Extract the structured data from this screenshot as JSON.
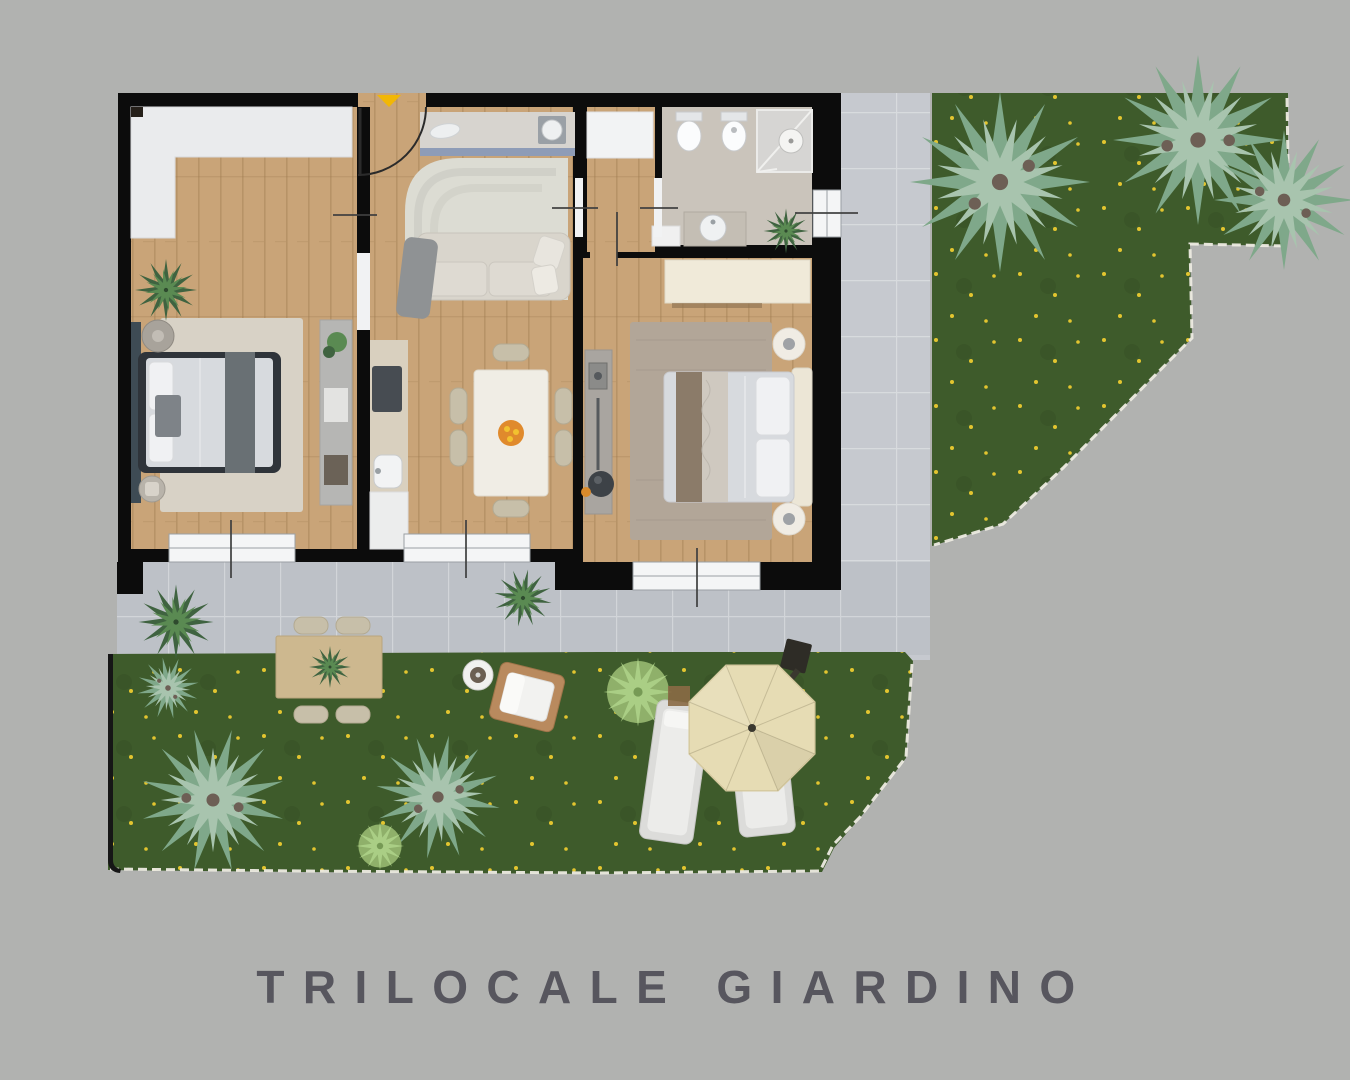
{
  "title": {
    "text": "TRILOCALE GIARDINO"
  },
  "colors": {
    "background": "#b1b2b0",
    "title_text": "#57565e",
    "wall": "#0c0c0c",
    "wood": "#c9a478",
    "wood_grain": "#9c7a4e",
    "bath_floor": "#cac4bb",
    "terrace": "#bdc1c7",
    "tile_grid": "#d2d5d9",
    "grass": "#3e5b2b",
    "grass_fringe": "#edebe2",
    "flower": "#e3c52f",
    "pine_dark": "#7fa88a",
    "pine_light": "#a8c4ae",
    "pine_core": "#6d5f55",
    "leaf_dark": "#3f6340",
    "leaf_light": "#5a8a52",
    "leaf_core": "#2e4a2e",
    "bush_base": "#8fb06a",
    "bush_star": "#aace85",
    "headboard_panel": "#3e4b54",
    "bed_frame": "#2f343a",
    "bedding": "#d7dade",
    "pillow": "#f0f1f3",
    "throw_blanket": "#697074",
    "rug_beige": "#d8d2c6",
    "rug_living": "#dcdcd3",
    "rug_taupe": "#b2a698",
    "wardrobe_white": "#eaebed",
    "wardrobe_cream": "#f0ead9",
    "closet_white": "#f2f3f4",
    "counter": "#d7d4cf",
    "counter_edge": "#8e9cb7",
    "kitchen_counter": "#d9d0bf",
    "hob": "#474c52",
    "appliance": "#9aa0a6",
    "fixture": "#fbfcfd",
    "fixture_edge": "#c8cacc",
    "shower": "#d6d5d3",
    "vanity": "#c4beb4",
    "shelf": "#b6b6b4",
    "sofa": "#d9d5cc",
    "sofa_edge": "#c8c4bb",
    "table_white": "#f0ede5",
    "chair": "#c7bfa9",
    "fruit": "#e08a2c",
    "fruit_dots": "#f2c12f",
    "console": "#a9a5a0",
    "stool": "#3d4247",
    "accent_orange": "#d98a2b",
    "window_fill": "#f4f5f6",
    "window_frame": "#9aa0a4",
    "entry_arrow": "#f2b705",
    "door_line": "#2b2b2b",
    "umbrella": "#e6dcb4",
    "umbrella_edge": "#d6caa0",
    "umbrella_arm": "#3a382f",
    "lounger": "#dcdcda",
    "lounger_inner": "#ececea",
    "outdoor_table": "#cdb88f",
    "armchair_frame": "#b98a5e",
    "side_table": "#f0ece4",
    "headboard_cream": "#ece6d6",
    "boundary": "#161616",
    "tick": "#3f3f3f"
  }
}
